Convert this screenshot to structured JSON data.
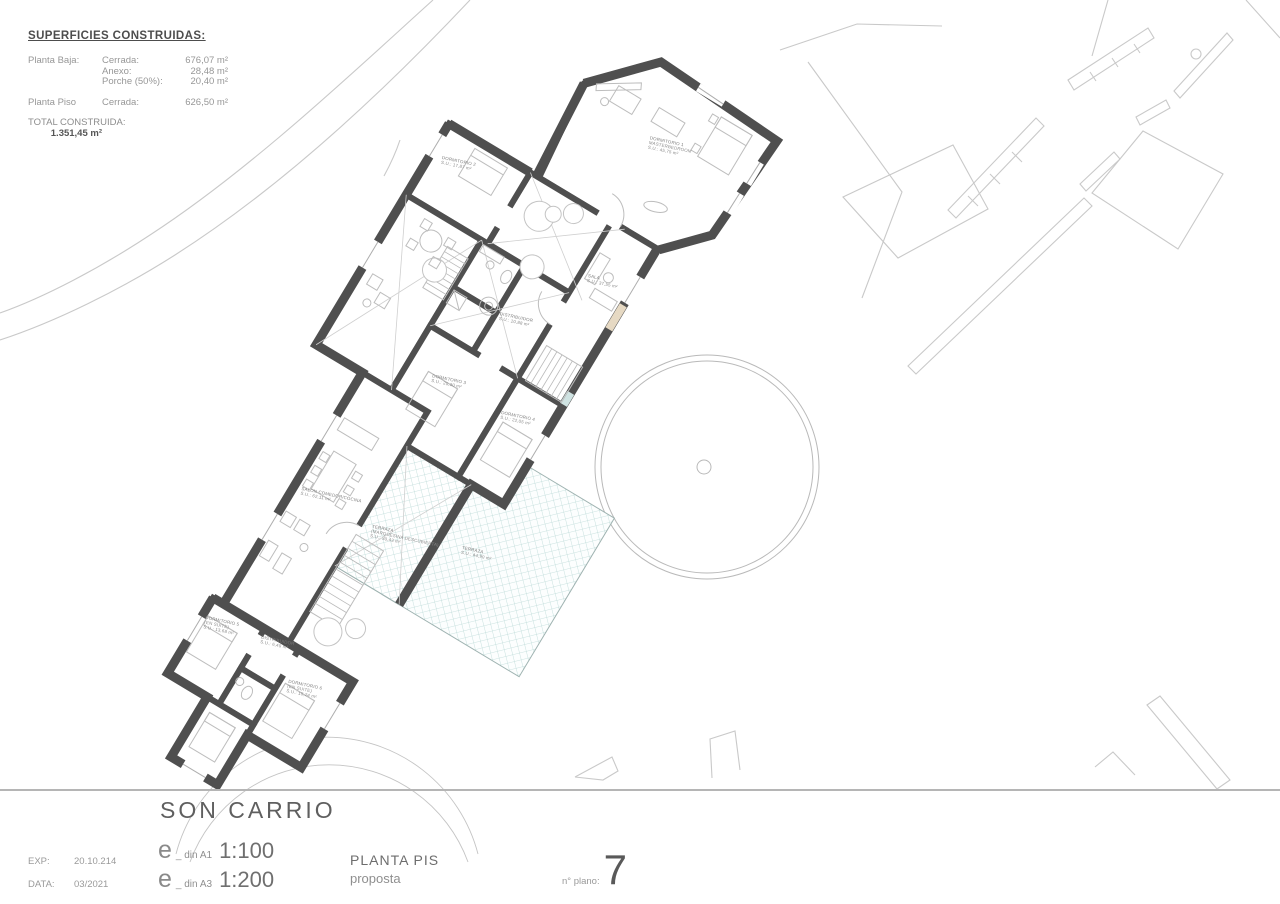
{
  "superficies": {
    "heading": "SUPERFICIES CONSTRUIDAS:",
    "rows": [
      {
        "c1": "Planta Baja:",
        "c2": "Cerrada:",
        "c3": "676,07 m²"
      },
      {
        "c1": "",
        "c2": "Anexo:",
        "c3": "28,48 m²"
      },
      {
        "c1": "",
        "c2": "Porche (50%):",
        "c3": "20,40 m²"
      }
    ],
    "rows2": [
      {
        "c1": "Planta Piso",
        "c2": "Cerrada:",
        "c3": "626,50 m²"
      }
    ],
    "total": {
      "c1": "TOTAL CONSTRUIDA:",
      "c2": "",
      "c3": "1.351,45 m²"
    }
  },
  "title_block": {
    "project_title": "SON CARRIO",
    "exp_label": "EXP:",
    "exp_value": "20.10.214",
    "data_label": "DATA:",
    "data_value": "03/2021",
    "scale_a1": {
      "e": "e",
      "din": "_ din A1",
      "ratio": "1:100"
    },
    "scale_a3": {
      "e": "e",
      "din": "_ din A3",
      "ratio": "1:200"
    },
    "drawing_name": "PLANTA PIS",
    "drawing_subtitle": "proposta",
    "plan_number_label": "n° plano:",
    "plan_number": "7"
  },
  "plan": {
    "rooms": [
      {
        "id": "dormitorio-1",
        "lines": [
          "DORMITORIO 1",
          "MASTERBEDROOM",
          "S.U.: 45,75 m²"
        ]
      },
      {
        "id": "dormitorio-2",
        "lines": [
          "DORMITORIO 2",
          "S.U.: 17,87 m²"
        ]
      },
      {
        "id": "sala",
        "lines": [
          "SALA",
          "S.U.: 37,55 m²"
        ]
      },
      {
        "id": "distribuidor",
        "lines": [
          "DISTRIBUIDOR",
          "S.U.: 10,88 m²"
        ]
      },
      {
        "id": "dormitorio-3",
        "lines": [
          "DORMITORIO 3",
          "S.U.: 20,30 m²"
        ]
      },
      {
        "id": "dormitorio-4",
        "lines": [
          "DORMITORIO 4",
          "S.U.: 22,05 m²"
        ]
      },
      {
        "id": "salon-comedor",
        "lines": [
          "SALON COMEDOR/COCINA",
          "S.U.: 62,11 m²"
        ]
      },
      {
        "id": "terraza-cubierta",
        "lines": [
          "TERRAZA",
          "(MARQUESINA DESCUBIERTA)",
          "S.U.: 30,43 m²"
        ]
      },
      {
        "id": "terraza",
        "lines": [
          "TERRAZA",
          "S.U.: 44,90 m²"
        ]
      },
      {
        "id": "dormitorio-5",
        "lines": [
          "DORMITORIO 5",
          "(EN SUITE)",
          "S.U.: 13,68 m²"
        ]
      },
      {
        "id": "distribuidor-2",
        "lines": [
          "DISTRIBUIDOR",
          "S.U.: 6,40 m²"
        ]
      },
      {
        "id": "dormitorio-6",
        "lines": [
          "DORMITORIO 6",
          "(EN SUITE)",
          "S.U.: 15,24 m²"
        ]
      }
    ]
  },
  "colors": {
    "wall": "#4f4f4f",
    "site": "#c9c9c9",
    "furn": "#bdbdbd",
    "hatch": "#b7d7d5",
    "beige": "#e6d9c3",
    "teal": "#cfe3e2",
    "txgray": "#8a8a8a",
    "txdark": "#5a5a5a"
  }
}
